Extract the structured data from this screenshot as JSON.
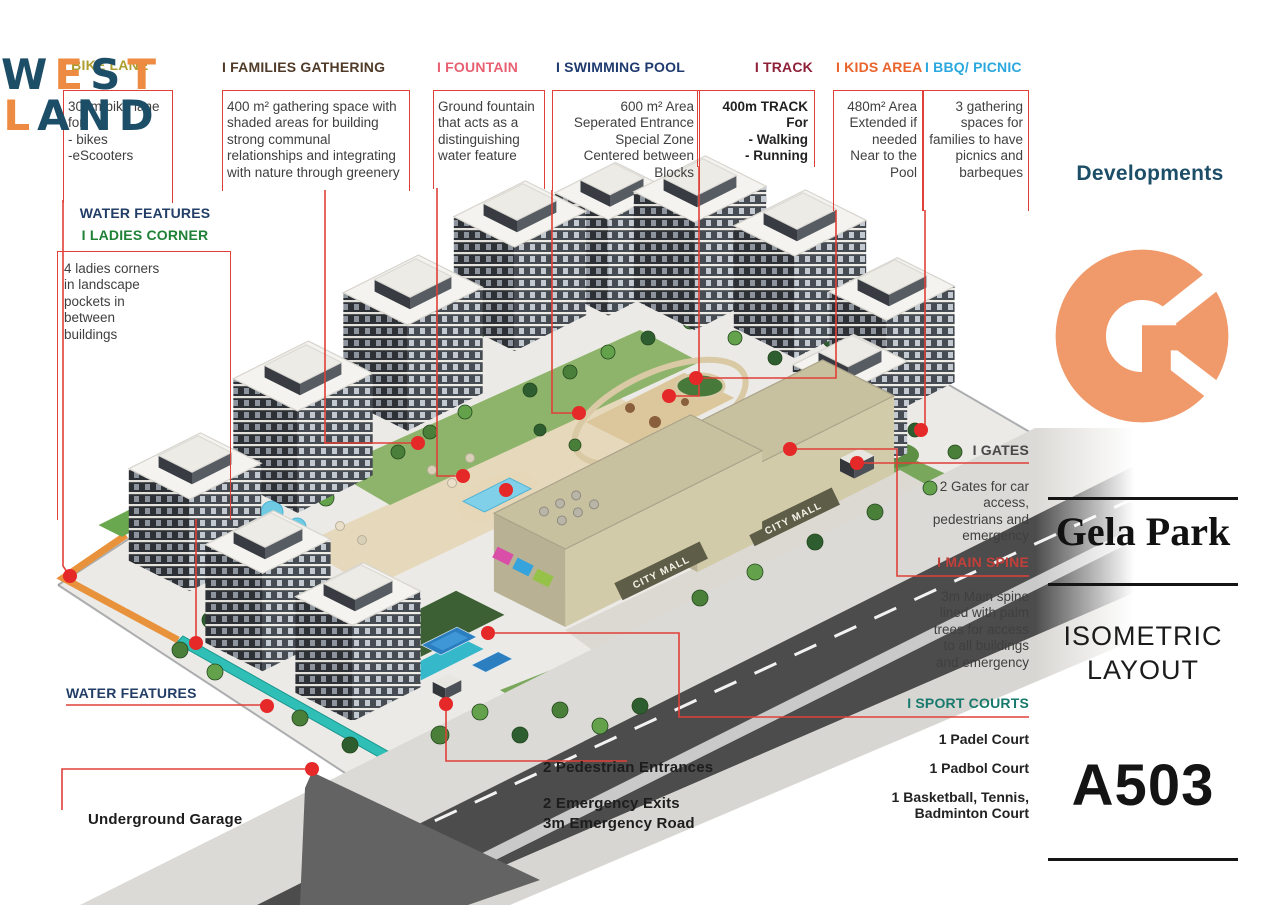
{
  "sidebar": {
    "brand": {
      "letters": [
        "W",
        "E",
        "S",
        "T",
        "L",
        "A",
        "N",
        "D"
      ],
      "subtitle": "Developments"
    },
    "project_name": "Gela Park",
    "view_title": "ISOMETRIC\nLAYOUT",
    "sheet_number": "A503"
  },
  "illustration": {
    "mall_sign": "CITY MALL"
  },
  "annotations": {
    "bike_lane": {
      "title": "I BIKE LANE",
      "description": "300m bike lane for\n- bikes\n-eScooters",
      "title_color": "#ac9d2e"
    },
    "families_gathering": {
      "title": "I FAMILIES GATHERING",
      "description": "400 m² gathering space with\nshaded areas for building\nstrong communal\nrelationships and integrating\nwith nature through greenery",
      "title_color": "#503b28"
    },
    "fountain": {
      "title": "I FOUNTAIN",
      "description": "Ground fountain\nthat acts as a\ndistinguishing\nwater feature",
      "title_color": "#e85f72"
    },
    "swimming_pool": {
      "title": "I SWIMMING POOL",
      "description": "600 m² Area\nSeperated Entrance\nSpecial Zone\nCentered between\nBlocks",
      "title_color": "#1e3a6e"
    },
    "track": {
      "title": "I TRACK",
      "description": "400m TRACK For\n- Walking\n- Running",
      "title_color": "#8e2038"
    },
    "kids_area": {
      "title": "I KIDS AREA",
      "description": "480m² Area\nExtended if\nneeded\nNear to the\nPool",
      "title_color": "#e9632b"
    },
    "bbq_picnic": {
      "title": "I BBQ/ PICNIC",
      "description": "3 gathering\nspaces for\nfamilies to have\npicnics and\nbarbeques",
      "title_color": "#2aa8de"
    },
    "water_features_left": {
      "title": "WATER FEATURES",
      "title_color": "#223e66"
    },
    "ladies_corner": {
      "title": "I LADIES CORNER",
      "description": "4 ladies corners\nin landscape\npockets in\nbetween\nbuildings",
      "title_color": "#1f8136"
    },
    "gates": {
      "title": "I GATES",
      "description": "2 Gates for car\naccess,\npedestrians and\nemergency",
      "title_color": "#474747"
    },
    "main_spine": {
      "title": "I MAIN SPINE",
      "description": "3m Main spine\nlined with palm\ntrees  for access\nto all buildings\nand emergency",
      "title_color": "#c2403a"
    },
    "sport_courts": {
      "title": "I SPORT COURTS",
      "title_color": "#187a6d",
      "items": [
        "1 Padel Court",
        "1 Padbol Court",
        "1 Basketball, Tennis,\nBadminton Court"
      ]
    },
    "water_features_bottom": {
      "title": "WATER FEATURES",
      "title_color": "#223e66"
    },
    "underground_garage": {
      "title": "Underground Garage"
    },
    "pedestrian_entrances": {
      "title": "2 Pedestrian Entrances"
    },
    "emergency": {
      "title": "2 Emergency Exits\n3m Emergency Road"
    }
  },
  "colors": {
    "annotation_red": "#e04038",
    "dot_red": "#e52828",
    "brand_navy": "#1d4e68",
    "brand_orange": "#ec8b41",
    "logo_orange": "#f0996a"
  }
}
